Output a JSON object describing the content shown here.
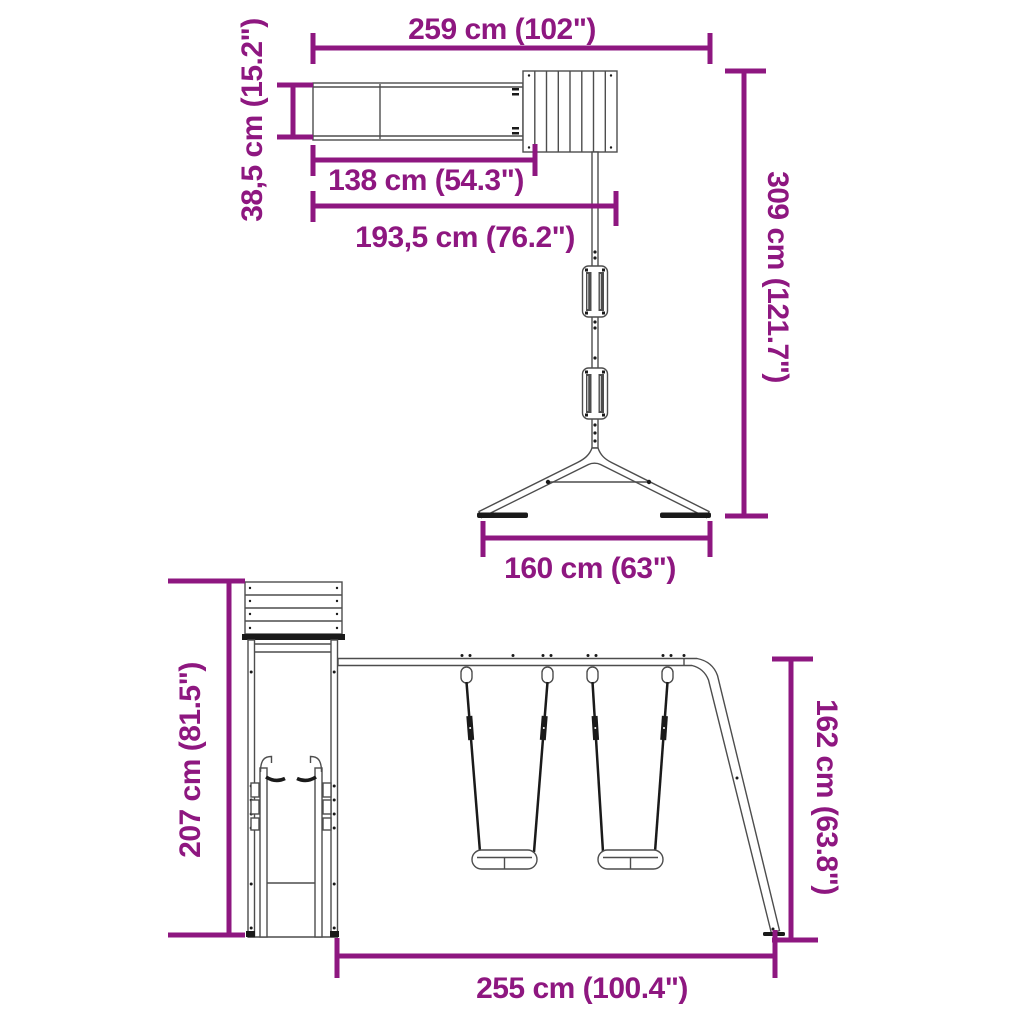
{
  "colors": {
    "accent": "#8E1780",
    "line": "#4D4D4D",
    "dark": "#1A1A1A",
    "background": "#FFFFFF"
  },
  "top_view": {
    "dimensions": {
      "total_width": {
        "label": "259 cm (102\")"
      },
      "slide_depth": {
        "label": "38,5 cm (15.2\")"
      },
      "slide_length": {
        "label": "138 cm (54.3\")"
      },
      "tower_length": {
        "label": "193,5 cm (76.2\")"
      },
      "total_length": {
        "label": "309 cm (121.7\")"
      },
      "base_width": {
        "label": "160 cm (63\")"
      }
    }
  },
  "side_view": {
    "dimensions": {
      "tower_height": {
        "label": "207 cm (81.5\")"
      },
      "swing_height": {
        "label": "162 cm (63.8\")"
      },
      "footprint_length": {
        "label": "255 cm (100.4\")"
      }
    }
  }
}
